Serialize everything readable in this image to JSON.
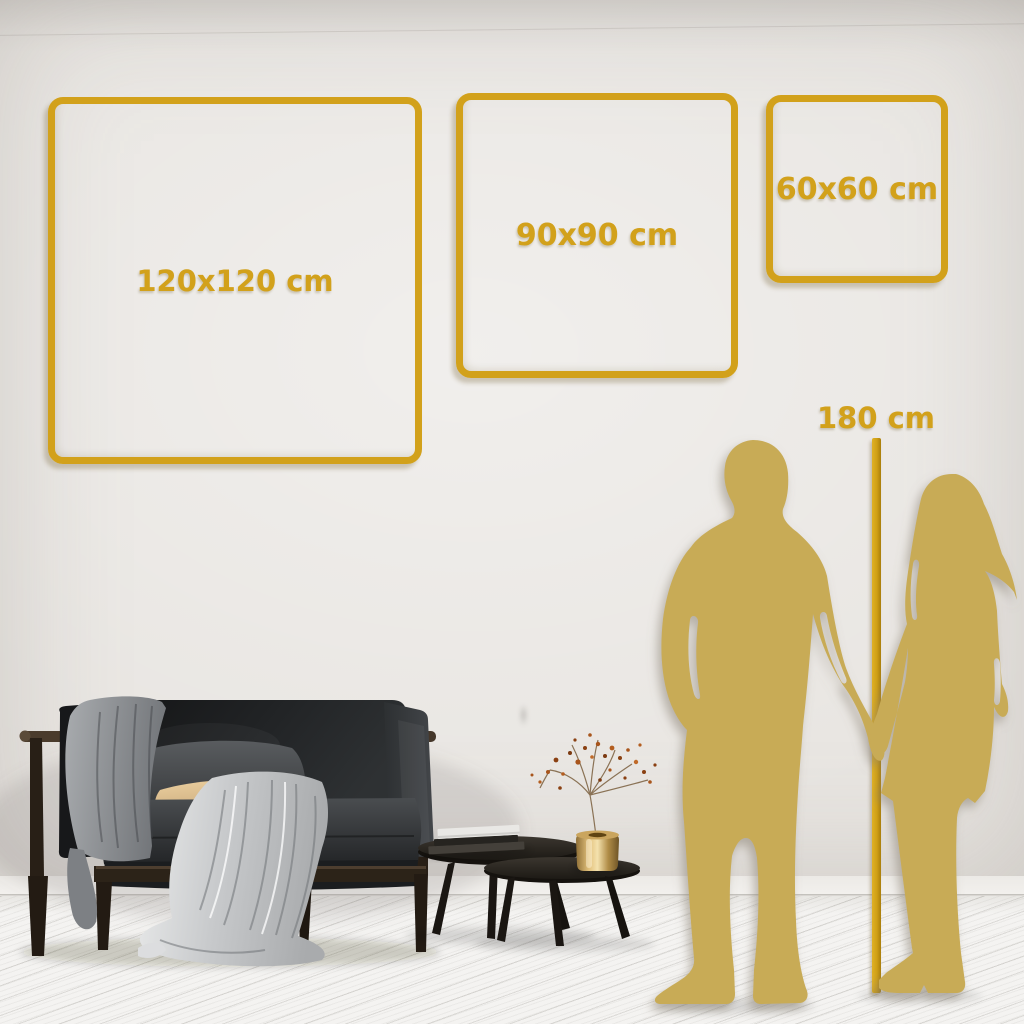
{
  "frames": [
    {
      "label": "120x120 cm"
    },
    {
      "label": "90x90 cm"
    },
    {
      "label": "60x60 cm"
    }
  ],
  "height_reference": {
    "label": "180 cm"
  },
  "colors": {
    "accent_gold": "#d2a11b",
    "silhouette_gold": "#c8ab56",
    "wall": "#e8e5e1",
    "floor": "#f4f3f1"
  }
}
